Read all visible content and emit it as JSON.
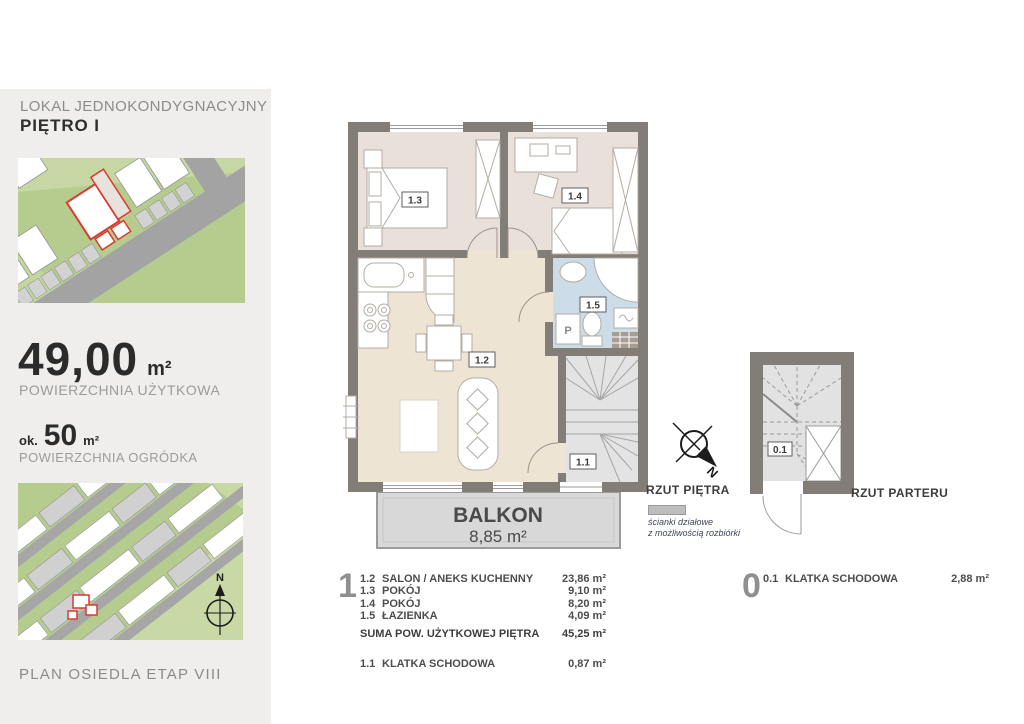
{
  "sidebar": {
    "title_line1": "LOKAL JEDNOKONDYGNACYJNY",
    "title_line2": "PIĘTRO I",
    "usable_area": {
      "value": "49,00",
      "unit": "m²",
      "label": "POWIERZCHNIA UŻYTKOWA"
    },
    "garden_area": {
      "prefix": "ok.",
      "value": "50",
      "unit": "m²",
      "label": "POWIERZCHNIA OGRÓDKA"
    },
    "footer": "PLAN OSIEDLA ETAP VIII",
    "map_compass_label": "N"
  },
  "floor_plan": {
    "title": "RZUT PIĘTRA",
    "note_line1": "ścianki działowe",
    "note_line2": "z możliwością rozbiórki",
    "balcony": {
      "label": "BALKON",
      "area": "8,85 m²"
    },
    "room_labels": {
      "living": "1.2",
      "bedroom_left": "1.3",
      "bedroom_right": "1.4",
      "bathroom": "1.5",
      "stairs": "1.1"
    },
    "washer_label": "P"
  },
  "ground_plan": {
    "title": "RZUT PARTERU",
    "room_label": "0.1"
  },
  "compass": {
    "label": "N"
  },
  "legend_floor": {
    "big_number": "1",
    "rows": [
      {
        "no": "1.2",
        "name": "SALON / ANEKS KUCHENNY",
        "area": "23,86 m²"
      },
      {
        "no": "1.3",
        "name": "POKÓJ",
        "area": "9,10 m²"
      },
      {
        "no": "1.4",
        "name": "POKÓJ",
        "area": "8,20 m²"
      },
      {
        "no": "1.5",
        "name": "ŁAZIENKA",
        "area": "4,09 m²"
      }
    ],
    "sum": {
      "label": "SUMA POW. UŻYTKOWEJ PIĘTRA",
      "area": "45,25 m²"
    },
    "stairs_row": {
      "no": "1.1",
      "name": "KLATKA SCHODOWA",
      "area": "0,87 m²"
    }
  },
  "legend_ground": {
    "big_number": "0",
    "row": {
      "no": "0.1",
      "name": "KLATKA SCHODOWA",
      "area": "2,88 m²"
    }
  },
  "colors": {
    "wall": "#837d77",
    "room_floor": "#e9e1d9",
    "living_floor": "#ede4d4",
    "bathroom_floor": "#ccdce8",
    "stairs_floor": "#e3e3e3",
    "balcony_fill": "#d8d8d8",
    "sidebar_bg": "#efeeec",
    "map_green": "#b6cc8f",
    "map_green_light": "#c8d9a5",
    "map_road": "#a3a3a3",
    "highlight_red": "#d63c30"
  }
}
